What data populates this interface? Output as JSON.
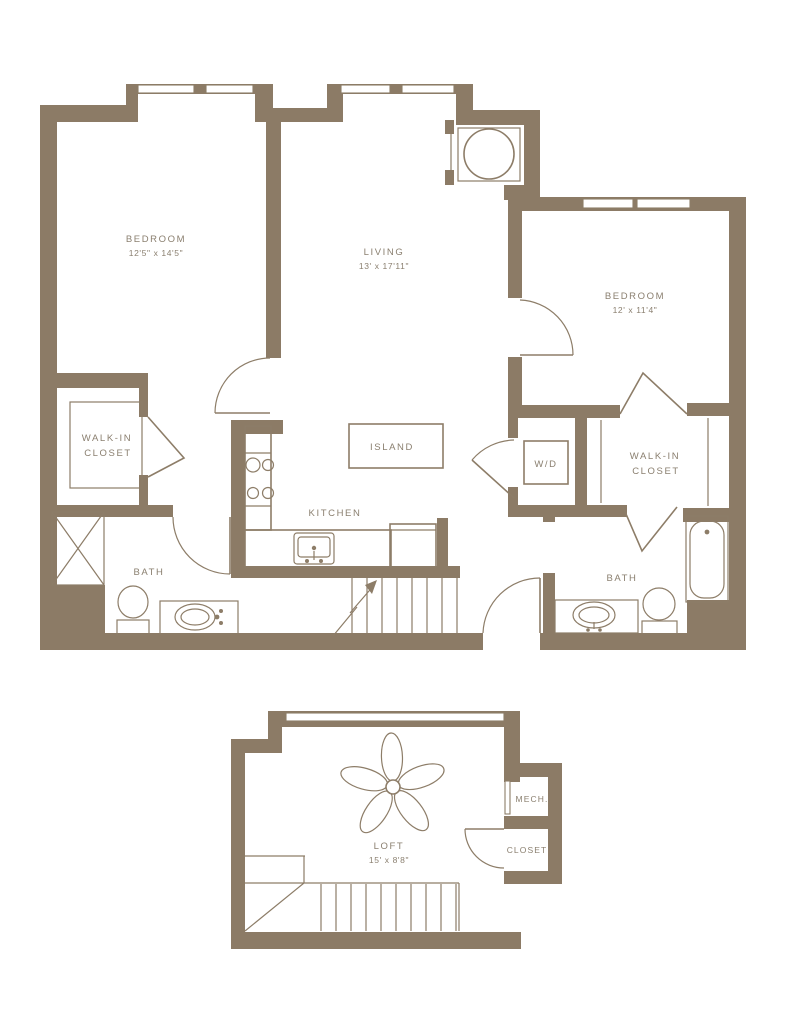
{
  "colors": {
    "wall_color": "#8c7b66",
    "line_color": "#8d7d68",
    "text_color": "#8a7f6f",
    "background_color": "#ffffff"
  },
  "main_level": {
    "bedroom1": {
      "label": "BEDROOM",
      "dimensions": "12'5\" x 14'5\""
    },
    "living": {
      "label": "LIVING",
      "dimensions": "13' x 17'11\""
    },
    "bedroom2": {
      "label": "BEDROOM",
      "dimensions": "12' x 11'4\""
    },
    "walk_in_closet_1": {
      "line1": "WALK-IN",
      "line2": "CLOSET"
    },
    "walk_in_closet_2": {
      "line1": "WALK-IN",
      "line2": "CLOSET"
    },
    "washer_dryer": {
      "label": "W/D"
    },
    "bath1": {
      "label": "BATH"
    },
    "bath2": {
      "label": "BATH"
    },
    "kitchen": {
      "label": "KITCHEN"
    },
    "island": {
      "label": "ISLAND"
    }
  },
  "loft_level": {
    "loft": {
      "label": "LOFT",
      "dimensions": "15' x 8'8\""
    },
    "mech": {
      "label": "MECH."
    },
    "closet": {
      "label": "CLOSET"
    }
  }
}
